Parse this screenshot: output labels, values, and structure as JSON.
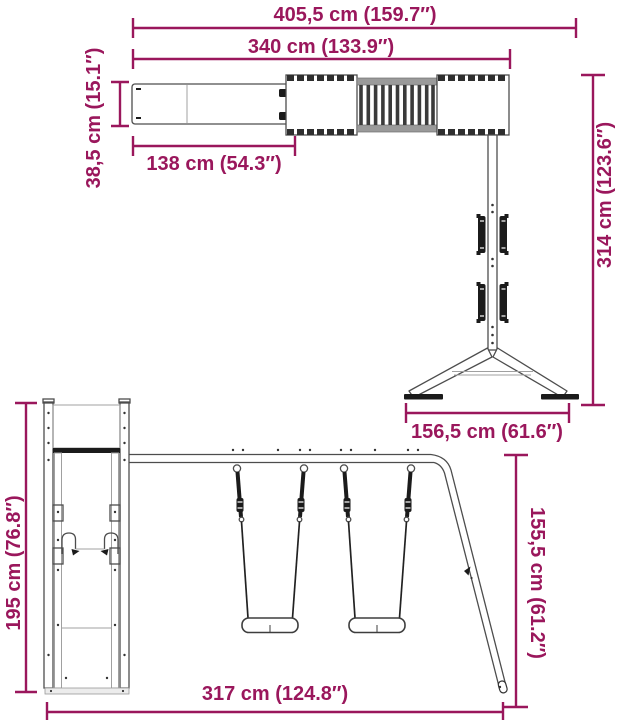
{
  "title": "Wooden playset with swings and slide — dimension diagram",
  "colors": {
    "dimension": "#9a175c",
    "outline": "#4d4d4d",
    "dark": "#1b1b1b",
    "gray": "#9a9a9a",
    "light_gray": "#ececec",
    "background": "#ffffff"
  },
  "views": {
    "top": {
      "label": "top-plan-view",
      "dims": {
        "total_length": "405,5 cm (159.7″)",
        "deck_length": "340 cm (133.9″)",
        "slide_width": "38,5 cm (15.1″)",
        "slide_length": "138 cm (54.3″)",
        "frame_depth": "314 cm (123.6″)",
        "stand_width": "156,5 cm (61.6″)"
      }
    },
    "front": {
      "label": "front-elevation-view",
      "dims": {
        "tower_height": "195 cm (76.8″)",
        "swing_frame_height": "155,5 cm (61.2″)",
        "swing_frame_length": "317 cm (124.8″)"
      }
    }
  }
}
